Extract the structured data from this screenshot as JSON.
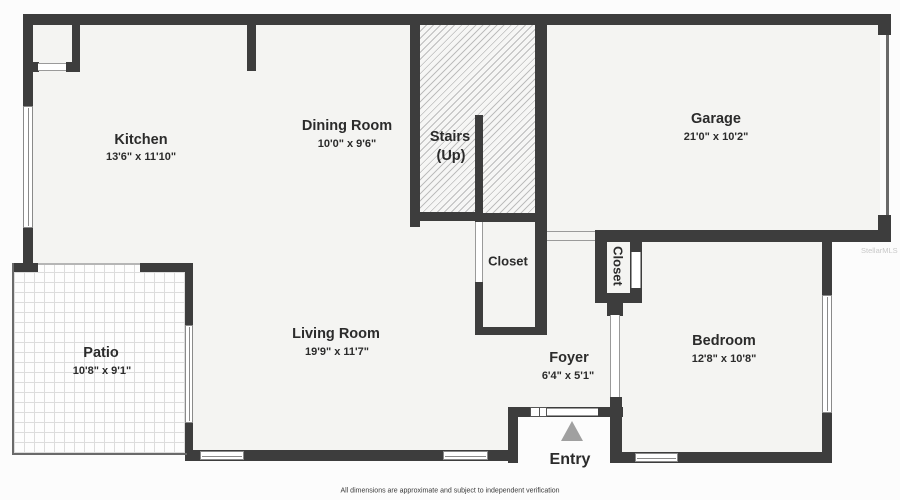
{
  "rooms": {
    "kitchen": {
      "name": "Kitchen",
      "dims": "13'6\" x 11'10\""
    },
    "dining": {
      "name": "Dining Room",
      "dims": "10'0\" x 9'6\""
    },
    "stairs": {
      "name": "Stairs",
      "sub": "(Up)"
    },
    "garage": {
      "name": "Garage",
      "dims": "21'0\" x 10'2\""
    },
    "closet_hall": {
      "name": "Closet"
    },
    "closet_bedroom": {
      "name": "Closet"
    },
    "patio": {
      "name": "Patio",
      "dims": "10'8\" x 9'1\""
    },
    "living": {
      "name": "Living Room",
      "dims": "19'9\" x 11'7\""
    },
    "foyer": {
      "name": "Foyer",
      "dims": "6'4\" x 5'1\""
    },
    "bedroom": {
      "name": "Bedroom",
      "dims": "12'8\" x 10'8\""
    }
  },
  "entry": {
    "label": "Entry"
  },
  "footer": {
    "disclaimer": "All dimensions are approximate and subject to independent verification"
  },
  "watermark": "StellarMLS",
  "colors": {
    "wall": "#3d3d3d",
    "floor": "#f4f4f2",
    "background": "#fcfcfc",
    "text": "#2b2b2b",
    "entry_arrow": "#a0a0a0",
    "hatch_line": "#bdbdbd",
    "tile_line": "#dcdcdc"
  }
}
